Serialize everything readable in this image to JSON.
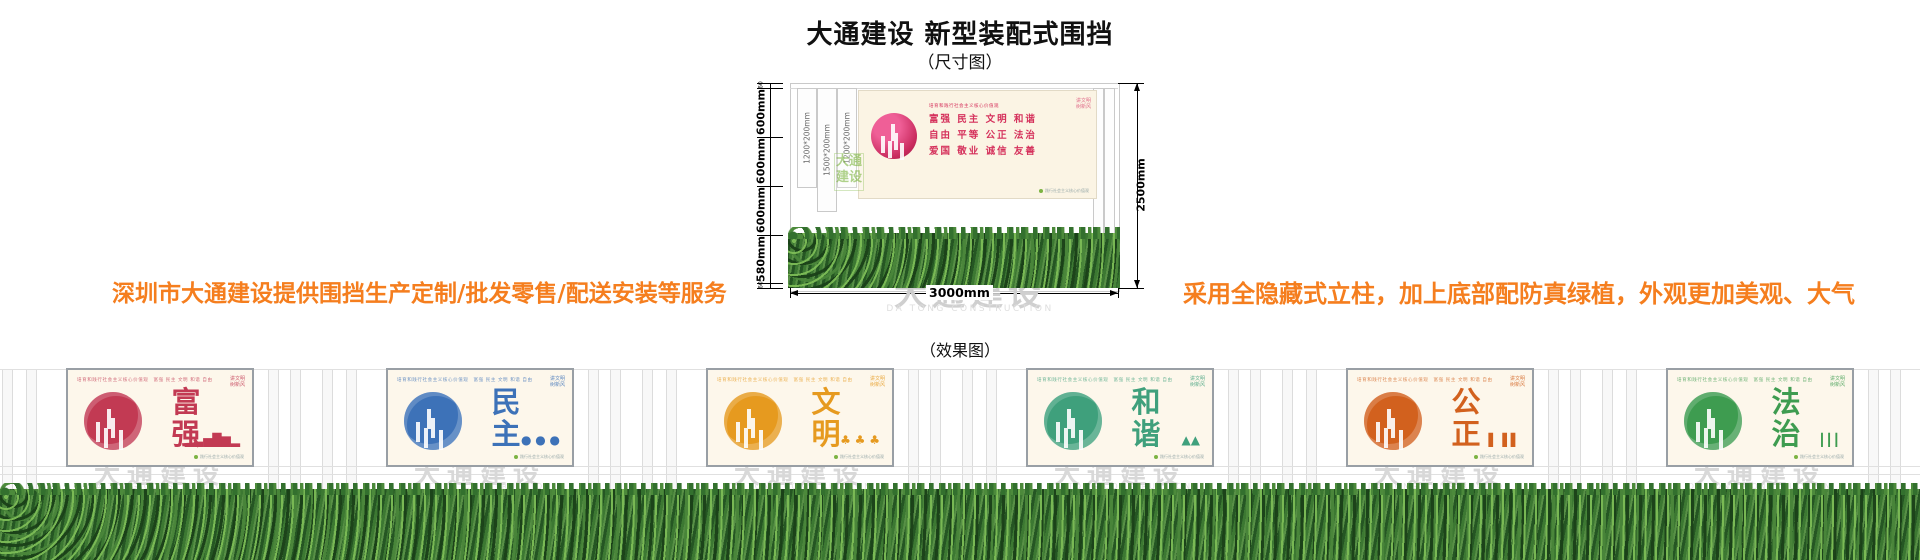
{
  "page": {
    "title": "大通建设 新型装配式围挡",
    "size_diagram_label": "（尺寸图）",
    "effect_diagram_label": "（效果图）"
  },
  "promos": {
    "left": "深圳市大通建设提供围挡生产定制/批发零售/配送安装等服务",
    "right": "采用全隐藏式立柱，加上底部配防真绿植，外观更加美观、大气",
    "color": "#F57E1E"
  },
  "dimension_diagram": {
    "total_height": "2500mm",
    "total_width": "3000mm",
    "height_segments": [
      {
        "label": "60"
      },
      {
        "label": "600mm"
      },
      {
        "label": "600mm"
      },
      {
        "label": "600mm"
      },
      {
        "label": "580mm"
      },
      {
        "label": "60"
      }
    ],
    "column_labels": [
      "1200*200mm",
      "1500*200mm",
      "1200*200mm"
    ],
    "banner": {
      "header": "培育和践行社会主义核心价值观",
      "rows": [
        "富强  民主  文明  和谐",
        "自由  平等  公正  法治",
        "爱国  敬业  诚信  友善"
      ],
      "corner_line1": "讲文明",
      "corner_line2": "树新风",
      "footnote": "践行社会主义核心价值观",
      "accent": "#D5305B",
      "circle_color": "#C92B5E",
      "green_mark": "大通建设"
    },
    "watermark_cn": "大通建设",
    "watermark_en": "DA TONG CONSTRUCTION"
  },
  "effect_view": {
    "watermark_cn": "大通建设",
    "watermark_en": "DA TONG CONSTRUCTION",
    "common": {
      "header_strip": "培育和践行社会主义核心价值观　富强 民主 文明 和谐 自由 平等 公正 法治 爱国 敬业 诚信 友善",
      "corner_line1": "讲文明",
      "corner_line2": "树新风",
      "footnote": "践行社会主义核心价值观"
    },
    "panels": [
      {
        "title": "富强",
        "color": "#C23A53",
        "motif": "▁▃▅█▆▂"
      },
      {
        "title": "民主",
        "color": "#3D72B8",
        "motif": "● ● ●"
      },
      {
        "title": "文明",
        "color": "#E69A1F",
        "motif": "♣ ♣ ♣"
      },
      {
        "title": "和谐",
        "color": "#3FA07C",
        "motif": "▲▲"
      },
      {
        "title": "公正",
        "color": "#D2611E",
        "motif": "▌▐ ▌"
      },
      {
        "title": "法治",
        "color": "#3E9C50",
        "motif": "┃┃┃"
      }
    ]
  }
}
